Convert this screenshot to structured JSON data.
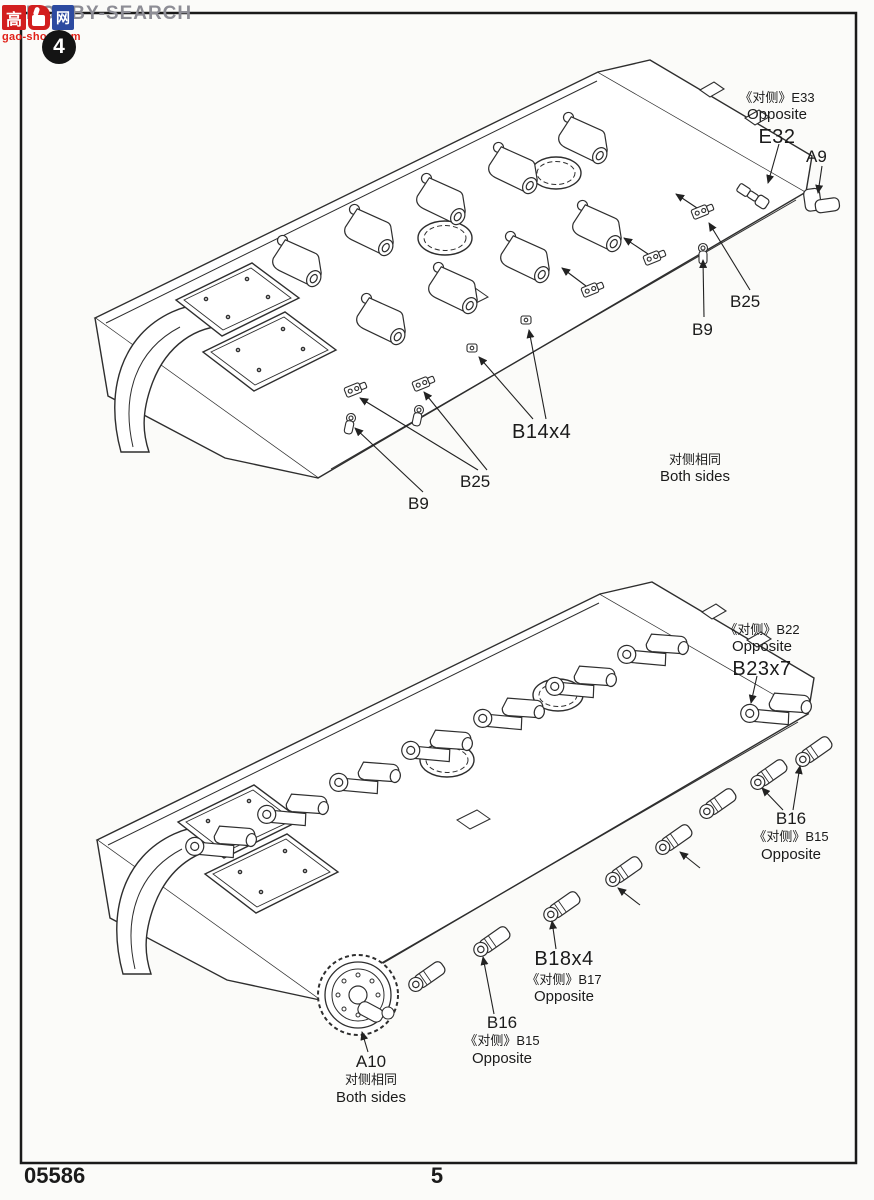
{
  "page": {
    "step_number": "4",
    "kit_number": "05586",
    "page_number": "5"
  },
  "watermark": {
    "logo_left": "高",
    "logo_right": "网",
    "logo_site": "gao-shou.com",
    "overlay": "HOBBY-SEARCH"
  },
  "colors": {
    "line_art": "#2e2e2e",
    "logo_red": "#d21e1e",
    "logo_blue": "#2c4aa0",
    "watermark_gray": "#8d8d95"
  },
  "diagram_top": {
    "callouts": [
      {
        "lines": [
          "《对侧》E33",
          "Opposite",
          "E32"
        ]
      },
      {
        "lines": [
          "A9"
        ]
      },
      {
        "lines": [
          "B25"
        ]
      },
      {
        "lines": [
          "B9"
        ]
      },
      {
        "lines": [
          "B14x4"
        ]
      },
      {
        "lines": [
          "B25"
        ]
      },
      {
        "lines": [
          "B9"
        ]
      },
      {
        "lines": [
          "对侧相同",
          "Both sides"
        ]
      }
    ]
  },
  "diagram_bottom": {
    "callouts": [
      {
        "lines": [
          "《对侧》B22",
          "Opposite",
          "B23x7"
        ]
      },
      {
        "lines": [
          "B16",
          "《对侧》B15",
          "Opposite"
        ]
      },
      {
        "lines": [
          "B18x4",
          "《对侧》B17",
          "Opposite"
        ]
      },
      {
        "lines": [
          "B16",
          "《对侧》B15",
          "Opposite"
        ]
      },
      {
        "lines": [
          "A10",
          "对侧相同",
          "Both sides"
        ]
      }
    ]
  }
}
